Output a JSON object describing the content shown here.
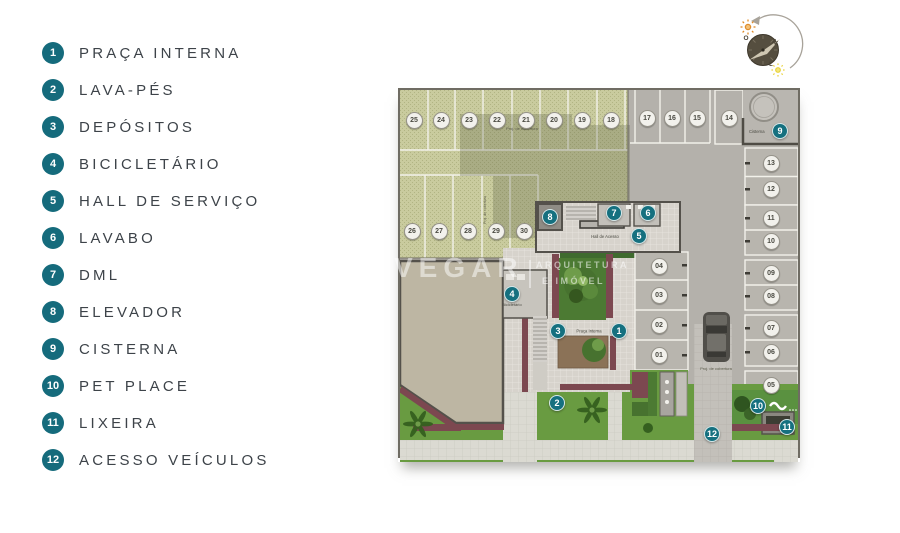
{
  "legend": {
    "items": [
      {
        "num": "1",
        "label": "PRAÇA INTERNA"
      },
      {
        "num": "2",
        "label": "LAVA-PÉS"
      },
      {
        "num": "3",
        "label": "DEPÓSITOS"
      },
      {
        "num": "4",
        "label": "BICICLETÁRIO"
      },
      {
        "num": "5",
        "label": "HALL DE SERVIÇO"
      },
      {
        "num": "6",
        "label": "LAVABO"
      },
      {
        "num": "7",
        "label": "DML"
      },
      {
        "num": "8",
        "label": "ELEVADOR"
      },
      {
        "num": "9",
        "label": "CISTERNA"
      },
      {
        "num": "10",
        "label": "PET PLACE"
      },
      {
        "num": "11",
        "label": "LIXEIRA"
      },
      {
        "num": "12",
        "label": "ACESSO VEÍCULOS"
      }
    ]
  },
  "watermark": {
    "brand": "VEGAR",
    "line1": "ARQUITETURA",
    "line2": "E IMÓVEL"
  },
  "compass": {
    "west": "O",
    "north": "N",
    "east": "L"
  },
  "plan": {
    "labels": {
      "proj_cobertura": "Proj. de cobertura",
      "proj_cobertura_side": "Proj. de cobertura",
      "proj_cobertura_drive": "Proj. de cobertura",
      "cisterna": "Cisterna",
      "hall_acesso": "Hall de Acesso",
      "praca_interna": "Praça Interna",
      "bicicletario": "Bicicletário"
    },
    "spots": [
      {
        "n": "25",
        "x": 16,
        "y": 32
      },
      {
        "n": "24",
        "x": 43,
        "y": 32
      },
      {
        "n": "23",
        "x": 71,
        "y": 32
      },
      {
        "n": "22",
        "x": 99,
        "y": 32
      },
      {
        "n": "21",
        "x": 128,
        "y": 32
      },
      {
        "n": "20",
        "x": 156,
        "y": 32
      },
      {
        "n": "19",
        "x": 184,
        "y": 32
      },
      {
        "n": "18",
        "x": 213,
        "y": 32
      },
      {
        "n": "17",
        "x": 249,
        "y": 30
      },
      {
        "n": "16",
        "x": 274,
        "y": 30
      },
      {
        "n": "15",
        "x": 299,
        "y": 30
      },
      {
        "n": "14",
        "x": 331,
        "y": 30
      },
      {
        "n": "26",
        "x": 14,
        "y": 143
      },
      {
        "n": "27",
        "x": 41,
        "y": 143
      },
      {
        "n": "28",
        "x": 70,
        "y": 143
      },
      {
        "n": "29",
        "x": 98,
        "y": 143
      },
      {
        "n": "30",
        "x": 126,
        "y": 143
      },
      {
        "n": "13",
        "x": 373,
        "y": 75
      },
      {
        "n": "12",
        "x": 373,
        "y": 101
      },
      {
        "n": "11",
        "x": 373,
        "y": 130
      },
      {
        "n": "10",
        "x": 373,
        "y": 153
      },
      {
        "n": "09",
        "x": 373,
        "y": 185
      },
      {
        "n": "08",
        "x": 373,
        "y": 208
      },
      {
        "n": "07",
        "x": 373,
        "y": 240
      },
      {
        "n": "06",
        "x": 373,
        "y": 264
      },
      {
        "n": "05",
        "x": 373,
        "y": 297
      },
      {
        "n": "04",
        "x": 261,
        "y": 178
      },
      {
        "n": "03",
        "x": 261,
        "y": 207
      },
      {
        "n": "02",
        "x": 261,
        "y": 237
      },
      {
        "n": "01",
        "x": 261,
        "y": 267
      }
    ],
    "badges": [
      {
        "n": "1",
        "x": 221,
        "y": 243
      },
      {
        "n": "2",
        "x": 159,
        "y": 315
      },
      {
        "n": "3",
        "x": 160,
        "y": 243
      },
      {
        "n": "4",
        "x": 114,
        "y": 206
      },
      {
        "n": "5",
        "x": 241,
        "y": 148
      },
      {
        "n": "6",
        "x": 250,
        "y": 125
      },
      {
        "n": "7",
        "x": 216,
        "y": 125
      },
      {
        "n": "8",
        "x": 152,
        "y": 129
      },
      {
        "n": "9",
        "x": 382,
        "y": 43
      },
      {
        "n": "10",
        "x": 360,
        "y": 318
      },
      {
        "n": "11",
        "x": 389,
        "y": 339
      },
      {
        "n": "12",
        "x": 314,
        "y": 346
      }
    ]
  },
  "colors": {
    "badge_teal": "#15707f",
    "grass": "#699b41",
    "hatch_green": "#c9cb9e",
    "lot_gray": "#b4b1ab",
    "building_beige": "#bdb6a3",
    "flower": "#7c4850"
  }
}
